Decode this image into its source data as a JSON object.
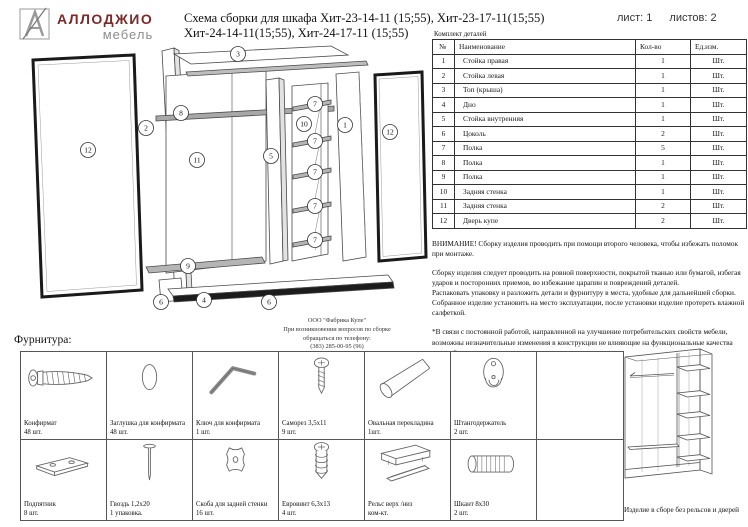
{
  "header": {
    "brand_line1": "АЛЛОДЖИО",
    "brand_line2": "мебель",
    "brand_color": "#7b2a2a",
    "title_line1": "Схема сборки для шкафа Хит-23-14-11 (15;55), Хит-23-17-11(15;55)",
    "title_line2": "Хит-24-14-11(15;55), Хит-24-17-11 (15;55)",
    "sheet_label": "лист: 1",
    "sheets_label": "листов: 2"
  },
  "parts_table": {
    "caption": "Комплект деталей",
    "columns": [
      "№",
      "Наименование",
      "Кол-во",
      "Ед.изм."
    ],
    "rows": [
      [
        "1",
        "Стойка правая",
        "1",
        "Шт."
      ],
      [
        "2",
        "Стойка левая",
        "1",
        "Шт."
      ],
      [
        "3",
        "Топ (крыша)",
        "1",
        "Шт."
      ],
      [
        "4",
        "Дно",
        "1",
        "Шт."
      ],
      [
        "5",
        "Стойка внутренняя",
        "1",
        "Шт."
      ],
      [
        "6",
        "Цоколь",
        "2",
        "Шт."
      ],
      [
        "7",
        "Полка",
        "5",
        "Шт."
      ],
      [
        "8",
        "Полка",
        "1",
        "Шт."
      ],
      [
        "9",
        "Полка",
        "1",
        "Шт."
      ],
      [
        "10",
        "Задняя стенка",
        "1",
        "Шт."
      ],
      [
        "11",
        "Задняя стенка",
        "2",
        "Шт."
      ],
      [
        "12",
        "Дверь купе",
        "2",
        "Шт."
      ]
    ]
  },
  "notes": {
    "warning": "ВНИМАНИЕ! Сборку изделия проводить при помощи второго человека, чтобы избежать поломок при монтаже.",
    "body1": "Сборку изделия следует проводить на ровной поверхности, покрытой тканью или бумагой, избегая ударов и посторонних приемов, во избежание царапин и повреждений деталей.",
    "body2": "Распаковать упаковку и разложить детали и фурнитуру в места, удобные для дальнейшей сборки.",
    "body3": "Собранное изделие установить на место эксплуатации, после установки изделие протереть влажной салфеткой.",
    "footnote": "*В связи с постоянной работой, направленной на улучшение потребительских свойств мебели, возможны незначительные изменения в конструкции не влияющие на функциональные качества изделий."
  },
  "manufacturer": {
    "line1": "ООО \"Фабрика Купе\"",
    "line2": "При возникновении вопросов по сборке",
    "line3": "обращаться по телефону:",
    "line4": "(383) 285-00-95 (96)"
  },
  "hardware": {
    "section_title": "Фурнитура:",
    "items": [
      {
        "name": "Конфирмат",
        "qty": "48 шт.",
        "icon": "confirmat-screw"
      },
      {
        "name": "Заглушка для конфирмата",
        "qty": "48 шт.",
        "icon": "oval-cap"
      },
      {
        "name": "Ключ для конфирмата",
        "qty": "1 шт.",
        "icon": "hex-key"
      },
      {
        "name": "Саморез 3,5х11",
        "qty": "9 шт.",
        "icon": "self-tapping-screw"
      },
      {
        "name": "Овальная перекладина",
        "qty": "1шт.",
        "icon": "oval-rod"
      },
      {
        "name": "Штангодержатель",
        "qty": "2 шт.",
        "icon": "rod-holder"
      },
      {
        "name": "Подпятник",
        "qty": "8 шт.",
        "icon": "foot-pad"
      },
      {
        "name": "Гвоздь 1,2х20",
        "qty": "1 упаковка.",
        "icon": "nail"
      },
      {
        "name": "Скоба для задней стенки",
        "qty": "16 шт.",
        "icon": "back-panel-bracket"
      },
      {
        "name": "Евровинт 6,3х13",
        "qty": "4 шт.",
        "icon": "euro-screw"
      },
      {
        "name": "Рельс верх /низ",
        "qty": "ком-кт.",
        "icon": "sliding-rail"
      },
      {
        "name": "Шкант 8х30",
        "qty": "2 шт.",
        "icon": "wood-dowel"
      }
    ]
  },
  "assembled_view": {
    "caption": "Изделие в сборе без рельсов и дверей"
  },
  "diagram": {
    "labels": [
      {
        "n": "12",
        "x": 72,
        "y": 108
      },
      {
        "n": "2",
        "x": 130,
        "y": 86
      },
      {
        "n": "8",
        "x": 165,
        "y": 71
      },
      {
        "n": "11",
        "x": 181,
        "y": 118
      },
      {
        "n": "3",
        "x": 222,
        "y": 12
      },
      {
        "n": "5",
        "x": 255,
        "y": 114
      },
      {
        "n": "10",
        "x": 288,
        "y": 82
      },
      {
        "n": "7",
        "x": 299,
        "y": 62
      },
      {
        "n": "7",
        "x": 299,
        "y": 99
      },
      {
        "n": "7",
        "x": 299,
        "y": 130
      },
      {
        "n": "7",
        "x": 299,
        "y": 164
      },
      {
        "n": "7",
        "x": 299,
        "y": 198
      },
      {
        "n": "1",
        "x": 329,
        "y": 83
      },
      {
        "n": "12",
        "x": 374,
        "y": 90
      },
      {
        "n": "9",
        "x": 172,
        "y": 224
      },
      {
        "n": "6",
        "x": 145,
        "y": 260
      },
      {
        "n": "4",
        "x": 188,
        "y": 258
      },
      {
        "n": "6",
        "x": 253,
        "y": 260
      }
    ]
  }
}
